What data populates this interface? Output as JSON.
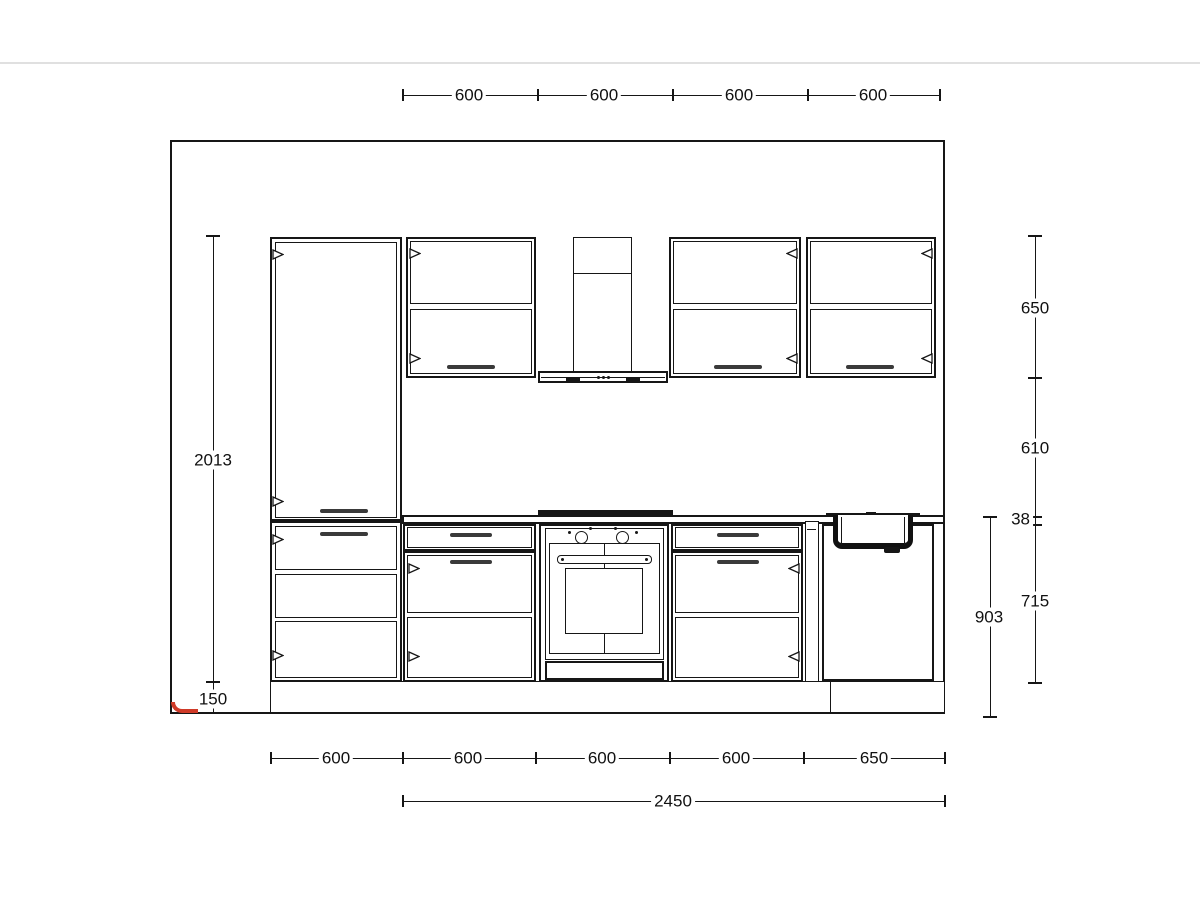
{
  "drawing": {
    "title": "kitchen-elevation-technical-drawing",
    "dims": {
      "top": [
        "600",
        "600",
        "600",
        "600"
      ],
      "bottom": [
        "600",
        "600",
        "600",
        "600",
        "650"
      ],
      "overall_width": "2450",
      "left": {
        "cabinet_total_height": "2013",
        "plinth_height": "150"
      },
      "right": {
        "wall_cabinet_height": "650",
        "splashback_gap": "610",
        "worktop_thickness": "38",
        "base_cabinet_height": "715",
        "worktop_level": "903"
      }
    },
    "colors": {
      "line": "#161616",
      "corner_marker": "#cf3a28",
      "background": "#ffffff"
    }
  }
}
